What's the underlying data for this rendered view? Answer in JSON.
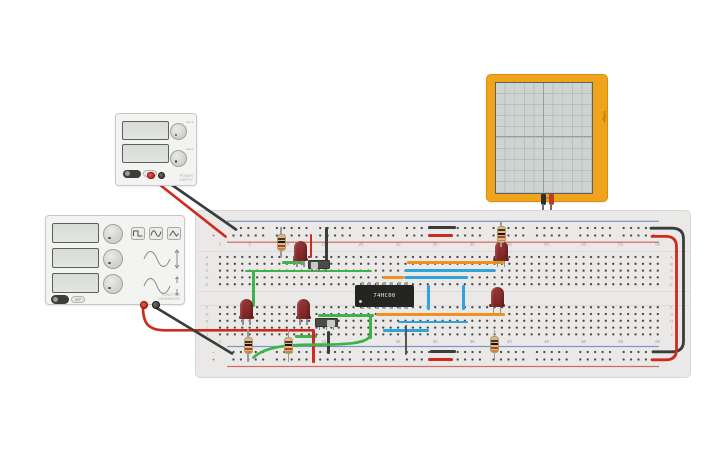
{
  "app": {
    "background": "#ffffff"
  },
  "palette": {
    "wire_red": "#cf2a1e",
    "wire_black": "#3c3c3a",
    "wire_green": "#3cb44a",
    "wire_orange": "#f0911e",
    "wire_blue": "#2fa3dc",
    "wire_gray": "#565654",
    "board_bg": "#eae9e7",
    "dot": "#4a4a48",
    "label": "#9b9b99",
    "rail_blue": "#5b83b8",
    "rail_red": "#cc4a40",
    "led_body": "#8c2f2f",
    "leg": "#8f8f8d",
    "res_body": "#d8b98d",
    "res_bands": [
      "#4a3526",
      "#161616",
      "#b5401f",
      "#b98f3e"
    ],
    "ic_body": "#242422",
    "ic_pin": "#a0a09e",
    "scope_frame": "#f0a41c",
    "scope_screen": "#ccd5d2",
    "terminal_red": "#c62f23",
    "terminal_black": "#3a3a38"
  },
  "instruments": {
    "power_supply": {
      "channel_labels": [
        "CH-1",
        "CH-2"
      ],
      "power_label": "OFF",
      "brand_line1": "POWER",
      "brand_line2": "SUPPLY"
    },
    "function_generator": {
      "power_label": "OFF",
      "brand_line1": "FUNCTION",
      "brand_line2": "GENERATOR"
    },
    "oscilloscope": {
      "bottom_label": "Time",
      "side_label": "Voltage"
    }
  },
  "breadboard": {
    "column_label_values": [
      "1",
      "5",
      "10",
      "15",
      "20",
      "25",
      "30",
      "35",
      "40",
      "45",
      "50",
      "55",
      "60"
    ],
    "column_label_indices": [
      1,
      5,
      10,
      15,
      20,
      25,
      30,
      35,
      40,
      45,
      50,
      55,
      60
    ],
    "row_letters_top": [
      "A",
      "B",
      "C",
      "D",
      "E"
    ],
    "row_letters_bottom": [
      "F",
      "G",
      "H",
      "I",
      "J"
    ],
    "rail_minus_symbol": "−",
    "rail_plus_symbol": "+",
    "geom": {
      "x": 195,
      "y": 210,
      "w": 496,
      "h": 168,
      "col0": 220,
      "pitch": 7.42,
      "rows_top": [
        257,
        263.8,
        270.6,
        277.4,
        284.2
      ],
      "rows_bottom": [
        307.2,
        314,
        320.8,
        327.6,
        334.4
      ],
      "rail_rows": [
        228,
        235.5,
        352,
        359.5
      ],
      "rail_x0": 233.5,
      "rail_groups": 10,
      "rail_per": 5,
      "rail_group_pitch": 43.35,
      "num_rows": [
        244,
        341.5
      ],
      "letter_x": [
        207,
        671.5
      ],
      "symbol_x": [
        213.5,
        666.5
      ],
      "rail_lines": [
        {
          "y": 220.7,
          "c": "rail_blue"
        },
        {
          "y": 241.6,
          "c": "rail_red"
        },
        {
          "y": 345.9,
          "c": "rail_blue"
        },
        {
          "y": 365.9,
          "c": "rail_red"
        }
      ]
    }
  },
  "components": {
    "ic": {
      "label": "74HC00",
      "x": 355,
      "y": 285,
      "w": 59,
      "h": 21.5,
      "pins_per_side": 7
    },
    "leds": [
      {
        "x": 300.5,
        "y": 240.5
      },
      {
        "x": 501,
        "y": 240.5
      },
      {
        "x": 246.5,
        "y": 298.5
      },
      {
        "x": 303.5,
        "y": 298.5
      },
      {
        "x": 497,
        "y": 286.5
      }
    ],
    "resistors": [
      {
        "x": 281,
        "y": 227,
        "h": 31
      },
      {
        "x": 501,
        "y": 221,
        "h": 26
      },
      {
        "x": 248,
        "y": 329,
        "h": 33
      },
      {
        "x": 288.5,
        "y": 329,
        "h": 33
      },
      {
        "x": 494.5,
        "y": 330,
        "h": 29
      }
    ],
    "switches": [
      {
        "x": 307.5,
        "y": 259.8,
        "knob": "left"
      },
      {
        "x": 315,
        "y": 317.8,
        "knob": "right"
      }
    ]
  },
  "wires": {
    "segments": [
      {
        "o": "h",
        "x": 282,
        "y": 261,
        "l": 21,
        "c": "green"
      },
      {
        "o": "h",
        "x": 245,
        "y": 269.5,
        "l": 127,
        "c": "green"
      },
      {
        "o": "h",
        "x": 318,
        "y": 313.9,
        "l": 56,
        "c": "green"
      },
      {
        "o": "h",
        "x": 295,
        "y": 335,
        "l": 22,
        "c": "green"
      },
      {
        "o": "v",
        "x": 252.2,
        "y": 271,
        "l": 36,
        "c": "green"
      },
      {
        "o": "v",
        "x": 369.2,
        "y": 316,
        "l": 23,
        "c": "green"
      },
      {
        "o": "h",
        "x": 407,
        "y": 261,
        "l": 97,
        "c": "orange"
      },
      {
        "o": "h",
        "x": 383,
        "y": 276.2,
        "l": 21,
        "c": "orange"
      },
      {
        "o": "h",
        "x": 376,
        "y": 312.9,
        "l": 129,
        "c": "orange"
      },
      {
        "o": "h",
        "x": 405,
        "y": 268.9,
        "l": 90,
        "c": "blue"
      },
      {
        "o": "h",
        "x": 405,
        "y": 276.2,
        "l": 63,
        "c": "blue"
      },
      {
        "o": "v",
        "x": 427.2,
        "y": 284.5,
        "l": 25,
        "c": "blue"
      },
      {
        "o": "v",
        "x": 462.2,
        "y": 284.5,
        "l": 25,
        "c": "blue"
      },
      {
        "o": "h",
        "x": 398,
        "y": 320.6,
        "l": 70,
        "c": "blue"
      },
      {
        "o": "h",
        "x": 383,
        "y": 329,
        "l": 46,
        "c": "blue"
      },
      {
        "o": "v",
        "x": 309.7,
        "y": 233.5,
        "l": 24,
        "c": "red"
      },
      {
        "o": "v",
        "x": 312.2,
        "y": 329.5,
        "l": 33,
        "c": "red"
      },
      {
        "o": "h",
        "x": 428,
        "y": 234.2,
        "l": 25,
        "c": "red"
      },
      {
        "o": "h",
        "x": 428,
        "y": 358.2,
        "l": 25,
        "c": "red"
      },
      {
        "o": "v",
        "x": 325.2,
        "y": 226.5,
        "l": 38,
        "c": "black"
      },
      {
        "o": "v",
        "x": 327.2,
        "y": 331,
        "l": 23,
        "c": "black"
      },
      {
        "o": "h",
        "x": 428,
        "y": 226,
        "l": 28,
        "c": "black"
      },
      {
        "o": "h",
        "x": 430,
        "y": 350.2,
        "l": 26,
        "c": "black"
      },
      {
        "o": "v",
        "x": 404.7,
        "y": 325,
        "l": 30,
        "c": "gray"
      }
    ],
    "curves": [
      {
        "d": "M150,177 L225.5,236.5",
        "c": "red",
        "w": 2.7
      },
      {
        "d": "M160.5,177 L236,229.5",
        "c": "black",
        "w": 2.7
      },
      {
        "d": "M143,307 C143,323 148,330.3 165,330.3 L313.5,330.3",
        "c": "red",
        "w": 2.7
      },
      {
        "d": "M155,307 L232,353.5",
        "c": "black",
        "w": 2.7
      },
      {
        "d": "M651,228.2 L672,228.2 Q683.5,228.2 683.5,239 L683.5,341 Q683.5,351.8 672,351.8 L653,351.8",
        "c": "black",
        "w": 2.8
      },
      {
        "d": "M652,236.4 L666,236.4 Q676.5,236.4 676.5,247 L676.5,349.5 Q676.5,359.8 666,359.8 L652,359.8",
        "c": "red",
        "w": 2.8
      },
      {
        "d": "M253.5,357.5 C266,345.5 292,344.6 320,344.6 C345,344.6 367.5,343.5 370.3,335.5",
        "c": "green",
        "w": 2.7
      }
    ]
  }
}
